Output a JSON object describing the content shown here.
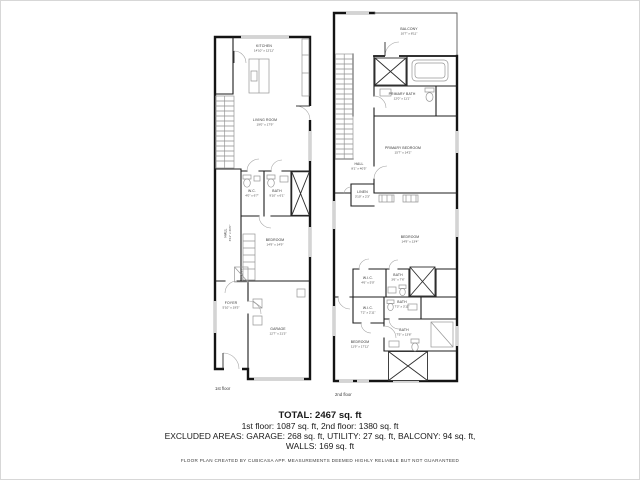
{
  "colors": {
    "wall": "#141414",
    "fixture": "#969696",
    "window": "#d4d4d4",
    "text": "#1a1a1a"
  },
  "footer": {
    "total": "TOTAL: 2467 sq. ft",
    "floors": "1st floor: 1087 sq. ft, 2nd floor: 1380 sq. ft",
    "excluded": "EXCLUDED AREAS: GARAGE: 268 sq. ft, UTILITY: 27 sq. ft, BALCONY: 94 sq. ft,",
    "walls": "WALLS: 169 sq. ft",
    "disclaimer": "FLOOR PLAN CREATED BY CUBICASA APP. MEASUREMENTS DEEMED HIGHLY RELIABLE BUT NOT GUARANTEED"
  },
  "floor1": {
    "label": "1st floor",
    "rooms": {
      "kitchen": {
        "name": "KITCHEN",
        "dims": "14'10\" x 12'11\""
      },
      "living": {
        "name": "LIVING ROOM",
        "dims": "19'0\" x 17'9\""
      },
      "wc": {
        "name": "W.C.",
        "dims": "4'0\" x 6'7\""
      },
      "bath": {
        "name": "BATH",
        "dims": "9'10\" x 6'1\""
      },
      "hall": {
        "name": "HALL",
        "dims": "3'11\" x 20'0\""
      },
      "bedroom": {
        "name": "BEDROOM",
        "dims": "14'9\" x 14'9\""
      },
      "utility": {
        "name": "UTILITY",
        "dims": ""
      },
      "foyer": {
        "name": "FOYER",
        "dims": "5'10\" x 19'5\""
      },
      "garage": {
        "name": "GARAGE",
        "dims": "12'7\" x 21'3\""
      }
    }
  },
  "floor2": {
    "label": "2nd floor",
    "rooms": {
      "balcony": {
        "name": "BALCONY",
        "dims": "10'7\" x 8'11\""
      },
      "primary_bath": {
        "name": "PRIMARY BATH",
        "dims": "12'0\" x 11'1\""
      },
      "primary_bedroom": {
        "name": "PRIMARY BEDROOM",
        "dims": "15'7\" x 14'2\""
      },
      "hall": {
        "name": "HALL",
        "dims": "8'1\" x 40'5\""
      },
      "linen": {
        "name": "LINEN",
        "dims": "3'10\" x 2'3\""
      },
      "bedroom1": {
        "name": "BEDROOM",
        "dims": "14'9\" x 13'4\""
      },
      "wic1": {
        "name": "W.I.C.",
        "dims": "4'6\" x 5'0\""
      },
      "bath1": {
        "name": "BATH",
        "dims": "3'6\" x 7'6\""
      },
      "bath2": {
        "name": "BATH",
        "dims": "7'3\" x 3'11\""
      },
      "wic2": {
        "name": "W.I.C.",
        "dims": "7'2\" x 2'11\""
      },
      "bath3": {
        "name": "BATH",
        "dims": "7'5\" x 13'8\""
      },
      "bedroom2": {
        "name": "BEDROOM",
        "dims": "11'9\" x 17'11\""
      }
    }
  }
}
